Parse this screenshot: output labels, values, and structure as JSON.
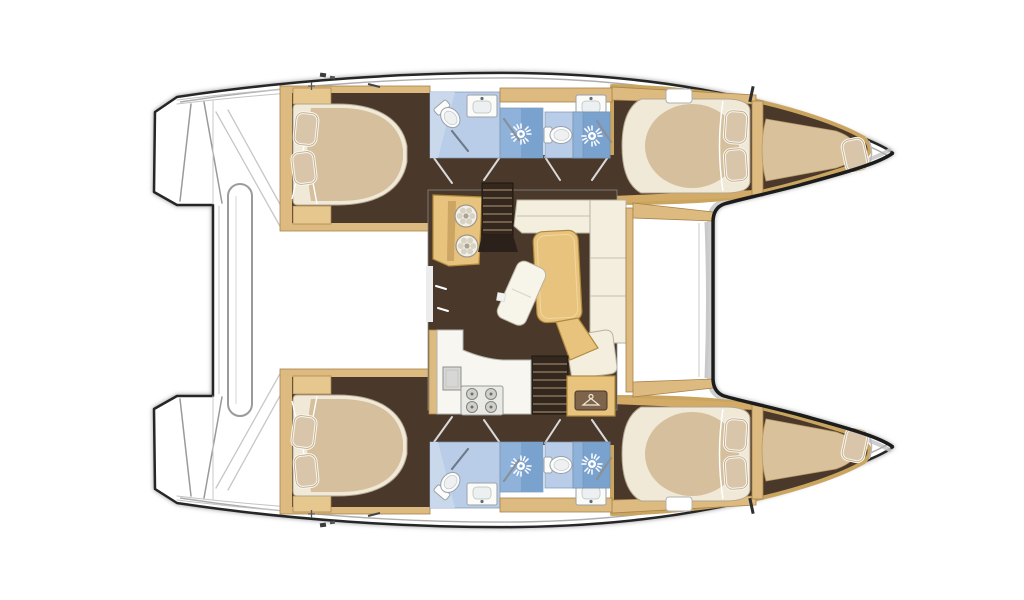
{
  "title": "Catamaran interior floor plan",
  "description": "Top-down floor plan of a 4-cabin sailing catamaran: two hulls with double cabins, heads and shower cubicles, central saloon with galley, dining table, L-shaped sofa, twin companionway stairs and wardrobe; forward cockpit benches and aft transom steps.",
  "palette": {
    "floor": "#4a382a",
    "wood": "#ddba80",
    "wood_dark": "#a8824b",
    "wood_light": "#e6c78e",
    "bed_cream": "#f0e9d8",
    "bed_beige": "#d5bf9c",
    "pillow": "#d8c5aa",
    "bath_blue": "#b9cde8",
    "shower_blue": "#8fb2da",
    "shower_blue_dark": "#7aa2cf",
    "fixture": "#fbfbf8",
    "sofa": "#f3eede",
    "table": "#e8c37e",
    "stairs": "#34281e",
    "tread": "#73604b",
    "outline": "#262626",
    "hull_white": "#ffffff"
  },
  "vessel": {
    "type": "catamaran",
    "view": "top-down interior layout",
    "counts": {
      "double_cabins": 4,
      "heads": 4,
      "shower_cubicles": 4,
      "forepeak_berths": 2,
      "companionway_stairs": 2,
      "pillows": 10
    }
  },
  "components": {
    "saloon": [
      "galley-unit-twin-burners",
      "companionway-stairs-port",
      "l-shaped-sofa",
      "dining-table",
      "chaise-seat",
      "galley-counter",
      "galley-sink",
      "four-burner-stove",
      "companionway-stairs-starboard",
      "wardrobe-with-hanger"
    ],
    "port_hull": [
      "aft-double-cabin",
      "aft-head-toilet",
      "aft-head-sink",
      "aft-shower-cubicle",
      "fwd-head-toilet",
      "fwd-head-sink",
      "fwd-shower-cubicle",
      "fwd-double-cabin",
      "forepeak-berth",
      "deck-hatch"
    ],
    "starboard_hull": [
      "aft-double-cabin",
      "aft-head-toilet",
      "aft-head-sink",
      "aft-shower-cubicle",
      "fwd-head-toilet",
      "fwd-head-sink",
      "fwd-shower-cubicle",
      "fwd-double-cabin",
      "forepeak-berth",
      "deck-hatch"
    ],
    "exterior": [
      "transom-steps-port",
      "transom-steps-starboard",
      "aft-crossbeam-bar",
      "forward-cockpit-benches",
      "bow-tips",
      "deck-fittings"
    ]
  }
}
